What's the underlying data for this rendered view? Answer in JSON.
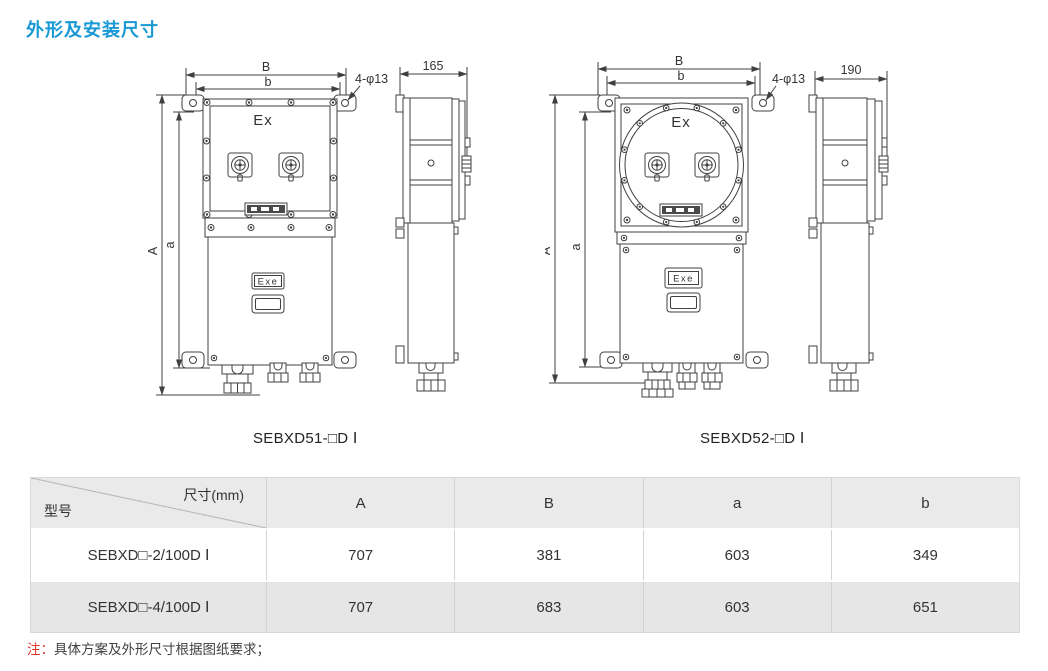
{
  "title": "外形及安装尺寸",
  "figures": [
    {
      "caption": "SEBXD51-□D Ⅰ",
      "labels": {
        "B": "B",
        "b": "b",
        "A": "A",
        "a": "a",
        "holes": "4-φ13",
        "ex": "Ex",
        "exe": "Exe",
        "depth": "165"
      }
    },
    {
      "caption": "SEBXD52-□D Ⅰ",
      "labels": {
        "B": "B",
        "b": "b",
        "A": "A",
        "a": "a",
        "holes": "4-φ13",
        "ex": "Ex",
        "exe": "Exe",
        "depth": "190"
      }
    }
  ],
  "table": {
    "corner_top": "尺寸(mm)",
    "corner_bottom": "型号",
    "columns": [
      "A",
      "B",
      "a",
      "b"
    ],
    "rows": [
      {
        "model": "SEBXD□-2/100D Ⅰ",
        "values": [
          "707",
          "381",
          "603",
          "349"
        ]
      },
      {
        "model": "SEBXD□-4/100D Ⅰ",
        "values": [
          "707",
          "683",
          "603",
          "651"
        ]
      }
    ]
  },
  "note": {
    "prefix": "注：",
    "text": "具体方案及外形尺寸根据图纸要求；"
  },
  "colors": {
    "accent_blue": "#1899d6",
    "note_red": "#e5352b",
    "drawing_line": "#404040",
    "table_header_bg": "#eaeaea",
    "table_alt_row_bg": "#e6e6e6",
    "table_border": "#d2d2d2"
  }
}
